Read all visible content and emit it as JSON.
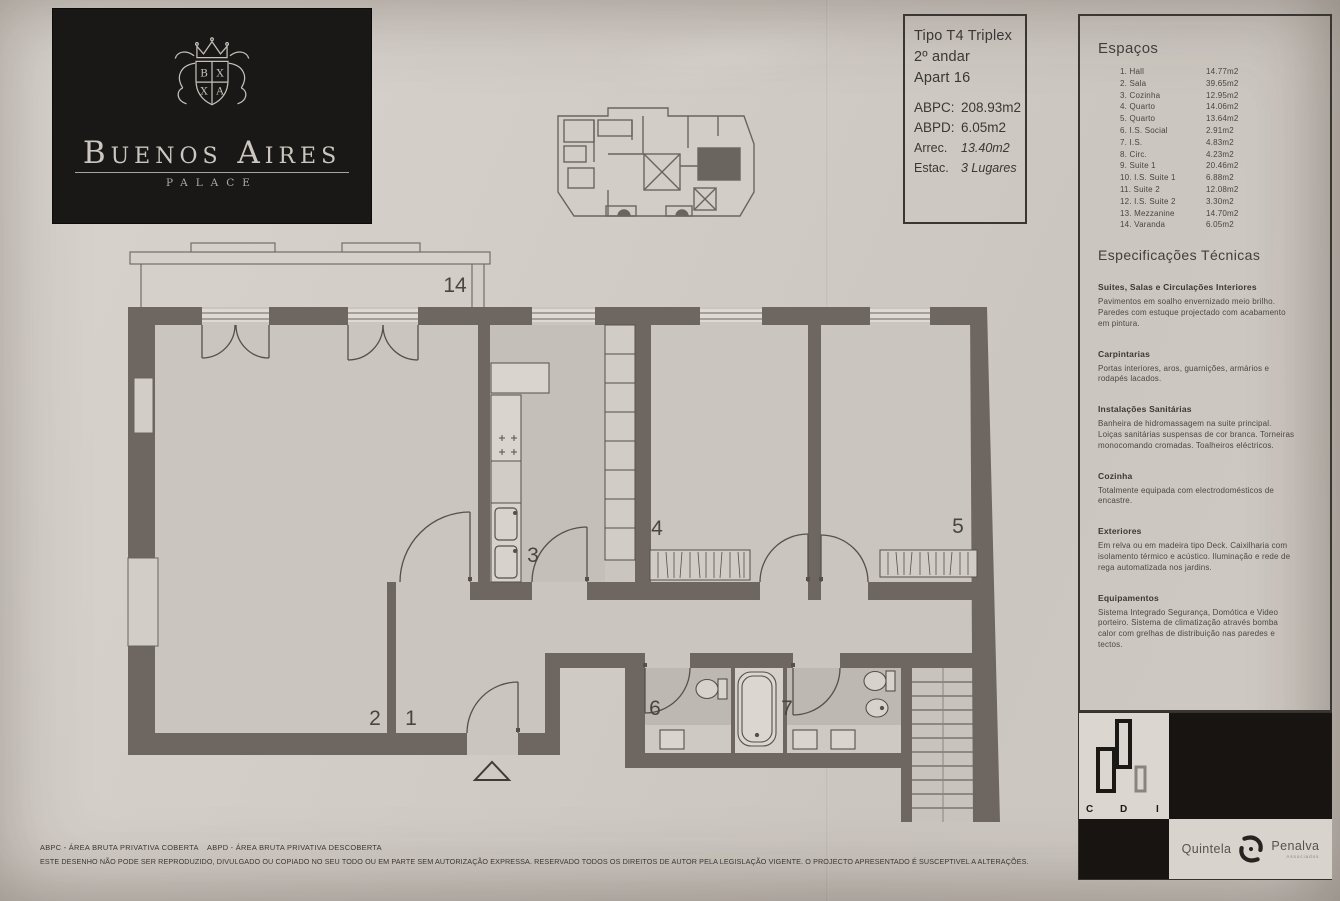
{
  "logo": {
    "title": "Buenos Aires",
    "subtitle": "PALACE"
  },
  "unit_info": {
    "line1": "Tipo T4 Triplex",
    "line2": "2º andar",
    "line3": "Apart 16",
    "metrics": [
      {
        "label": "ABPC:",
        "value": "208.93m2"
      },
      {
        "label": "ABPD:",
        "value": "6.05m2"
      },
      {
        "label": "Arrec.",
        "value": "13.40m2"
      },
      {
        "label": "Estac.",
        "value": "3 Lugares"
      }
    ]
  },
  "espacos": {
    "title": "Espaços",
    "rows": [
      {
        "name": "1. Hall",
        "area": "14.77m2"
      },
      {
        "name": "2. Sala",
        "area": "39.65m2"
      },
      {
        "name": "3. Cozinha",
        "area": "12.95m2"
      },
      {
        "name": "4. Quarto",
        "area": "14.06m2"
      },
      {
        "name": "5. Quarto",
        "area": "13.64m2"
      },
      {
        "name": "6. I.S. Social",
        "area": "2.91m2"
      },
      {
        "name": "7. I.S.",
        "area": "4.83m2"
      },
      {
        "name": "8. Circ.",
        "area": "4.23m2"
      },
      {
        "name": "9. Suite 1",
        "area": "20.46m2"
      },
      {
        "name": "10. I.S. Suite 1",
        "area": "6.88m2"
      },
      {
        "name": "11. Suite 2",
        "area": "12.08m2"
      },
      {
        "name": "12. I.S. Suite 2",
        "area": "3.30m2"
      },
      {
        "name": "13. Mezzanine",
        "area": "14.70m2"
      },
      {
        "name": "14. Varanda",
        "area": "6.05m2"
      }
    ]
  },
  "specs": {
    "title": "Especificações Técnicas",
    "sections": [
      {
        "heading": "Suites, Salas e Circulações Interiores",
        "body": "Pavimentos em soalho envernizado meio brilho. Paredes com estuque projectado com acabamento em pintura."
      },
      {
        "heading": "Carpintarias",
        "body": "Portas interiores, aros, guarnições, armários e rodapés lacados."
      },
      {
        "heading": "Instalações Sanitárias",
        "body": "Banheira de hidromassagem na suite principal. Loiças sanitárias suspensas de cor branca. Torneiras monocomando cromadas. Toalheiros eléctricos."
      },
      {
        "heading": "Cozinha",
        "body": "Totalmente equipada com electrodomésticos de encastre."
      },
      {
        "heading": "Exteriores",
        "body": "Em relva ou em madeira tipo Deck. Caixilharia com isolamento térmico e acústico. Iluminação e rede de rega automatizada nos jardins."
      },
      {
        "heading": "Equipamentos",
        "body": "Sistema Integrado Segurança, Domótica e Video porteiro. Sistema de climatização através bomba calor com grelhas de distribuição nas paredes e tectos."
      }
    ]
  },
  "plan": {
    "labels": {
      "varanda": "14",
      "sala": "2",
      "hall": "1",
      "cozinha": "3",
      "quarto_4": "4",
      "quarto_5": "5",
      "is_social": "6",
      "is_7": "7"
    }
  },
  "footer": {
    "legend_abpc": "ABPC - ÁREA BRUTA PRIVATIVA COBERTA",
    "legend_abpd": "ABPD - ÁREA BRUTA PRIVATIVA DESCOBERTA",
    "disclaimer": "ESTE DESENHO NÃO PODE SER REPRODUZIDO, DIVULGADO OU COPIADO NO SEU TODO OU EM PARTE SEM AUTORIZAÇÃO EXPRESSA. RESERVADO TODOS OS DIREITOS DE AUTOR PELA LEGISLAÇÃO VIGENTE. O PROJECTO APRESENTADO É SUSCEPTIVEL A ALTERAÇÕES."
  },
  "brands": {
    "cdi": {
      "letters": [
        "C",
        "D",
        "I"
      ]
    },
    "agency": {
      "name_left": "Quintela",
      "name_right": "Penalva",
      "tagline": "Associados"
    }
  },
  "colors": {
    "paper": "#d1cbc5",
    "wall": "#6e6660",
    "ink": "#46413c",
    "logo_black": "#1a1816"
  }
}
